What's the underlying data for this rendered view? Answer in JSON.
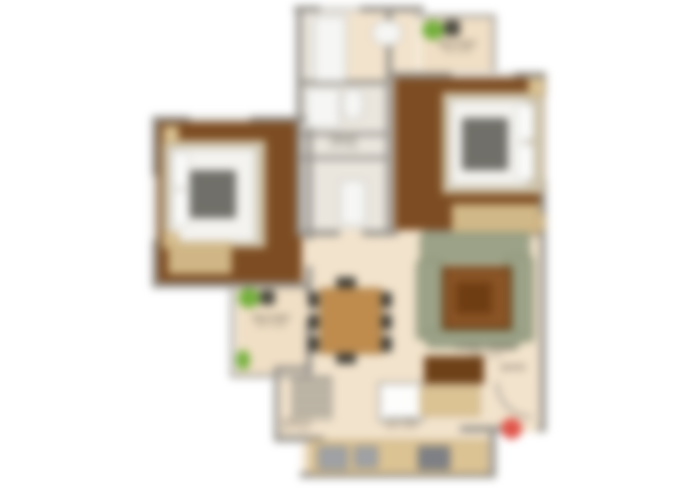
{
  "plan": {
    "type": "residential floor plan (2 bedroom apartment), blurred render",
    "rooms": [
      "bedroom-left",
      "bedroom-right",
      "living-dining",
      "kitchen",
      "toilet-upper",
      "toilet-lower",
      "balcony-top-right",
      "balcony-left",
      "utility-shelf-area",
      "foyer-entry"
    ]
  },
  "labels": {
    "balcony_top": {
      "name": "BALCONY",
      "dims": "7'6\" X 4'0\""
    },
    "toilet": {
      "name": "TOILET",
      "dims": "7'0\" X 4'6\""
    },
    "balcony_left": {
      "name": "BALCONY",
      "dims": "6'0\" X 4'6\""
    },
    "living": {
      "name": "LIVING / DINING",
      "dims": "17'0\" X 11'0\""
    },
    "kitchen": {
      "name": "KITCHEN",
      "dims": "10'0\" X 8'0\""
    },
    "utility": {
      "name": "UTILITY",
      "dims": "4'0\" X 6'0\""
    },
    "entry": {
      "name": "ENTRY",
      "dims": ""
    }
  },
  "colors": {
    "bg": "#ffffff",
    "wall": "#95918b",
    "wall_light": "#aaa6a0",
    "window": "#d9d6d1",
    "floor_wood": "#7d4c22",
    "floor_cream": "#f2e3cc",
    "floor_balcony": "#f0dfc5",
    "floor_tile": "#eae6de",
    "counter_tan": "#dbc394",
    "wood_trim": "#b0915c",
    "bed_frame": "#cfc5ae",
    "mattress": "#f4f3ef",
    "blanket": "#67665f",
    "sofa": "#9ba287",
    "rug": "#8a5426",
    "rug_border": "#5f3a12",
    "coffee_table": "#6f3d12",
    "table_wood": "#bf8c4e",
    "chair_dark": "#45423a",
    "plant": "#74b03c",
    "pot": "#4c4a40",
    "fixture": "#f6f6f4",
    "fixture_border": "#b3b0aa",
    "shelf": "#cfc5b2",
    "shelf_line": "#8e8a82",
    "steel": "#9fa1a4",
    "stove": "#7e8085",
    "door_wood": "#6e4118",
    "accent_red": "#e0544a",
    "text": "#5c5348"
  }
}
